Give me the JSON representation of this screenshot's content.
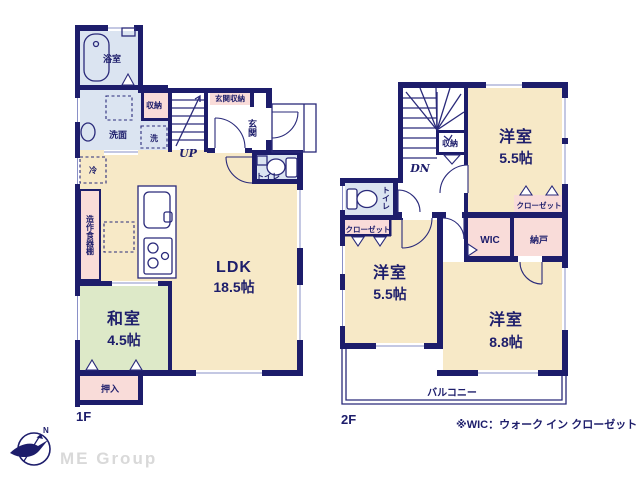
{
  "colors": {
    "wall_navy": "#1d1d6b",
    "room_beige": "#f7e9c7",
    "room_blue": "#dbe4f1",
    "room_pink": "#f9dcd9",
    "room_green": "#dde9c8",
    "watermark_gray": "#d9d9d9"
  },
  "floor1": {
    "label": "1F",
    "bath": "浴室",
    "storage": "収納",
    "washroom": "洗面",
    "washer": "洗",
    "entrance_storage": "玄関収納",
    "entrance": "玄関",
    "stairs_up": "UP",
    "toilet": "トイレ",
    "fridge": "冷",
    "cupboard": "造作食器棚",
    "ldk_name": "LDK",
    "ldk_size": "18.5帖",
    "washitsu_name": "和室",
    "washitsu_size": "4.5帖",
    "oshiire": "押入"
  },
  "floor2": {
    "label": "2F",
    "stairs_down": "DN",
    "storage": "収納",
    "toilet": "トイレ",
    "closet_top": "クローゼット",
    "closet_left": "クローゼット",
    "wic": "WIC",
    "nando": "納戸",
    "room1_name": "洋室",
    "room1_size": "5.5帖",
    "room2_name": "洋室",
    "room2_size": "5.5帖",
    "room3_name": "洋室",
    "room3_size": "8.8帖",
    "balcony": "バルコニー"
  },
  "footer": {
    "note": "※WIC：ウォーク イン クローゼット",
    "brand": "ME Group",
    "compass_north": "N"
  }
}
